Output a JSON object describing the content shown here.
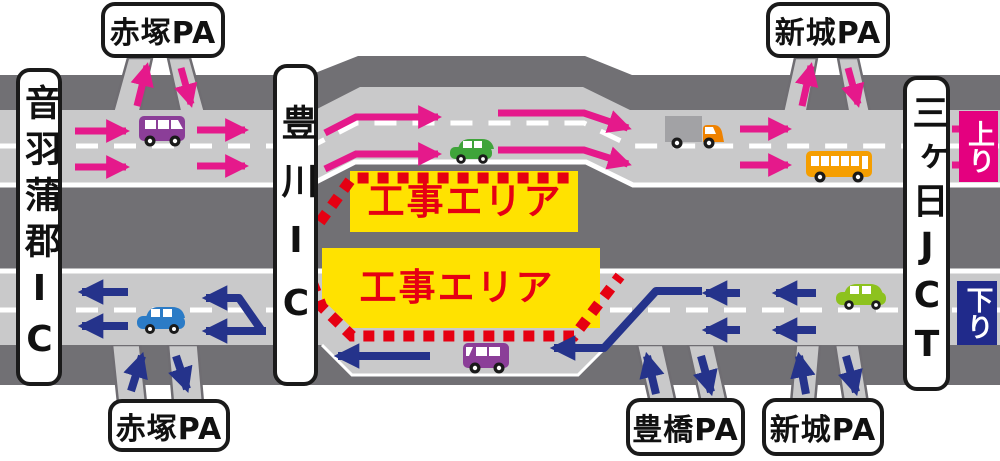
{
  "labels": {
    "pa_akatsuka": "赤塚PA",
    "pa_shinshiro": "新城PA",
    "pa_toyohashi": "豊橋PA",
    "ic_otowa_gamagori": "音羽蒲郡IC",
    "ic_toyokawa": "豊川IC",
    "jct_mikkabi": "三ヶ日JCT",
    "direction_up": "上り",
    "direction_down": "下り",
    "construction_area": "工事エリア"
  },
  "colors": {
    "up_accent": "#e4007f",
    "down_accent": "#202a8b",
    "construction_bg": "#ffe200",
    "construction_text": "#e60012",
    "dotted_line_red": "#e60012",
    "road_surface": "#c9c9ca",
    "road_base": "#717074",
    "lane_marking": "#ffffff"
  },
  "vehicles": [
    {
      "type": "van",
      "color": "#8b3e98",
      "road": "up"
    },
    {
      "type": "car",
      "color": "#3fa43a",
      "road": "up"
    },
    {
      "type": "truck",
      "color": "#ef8200",
      "road": "up"
    },
    {
      "type": "bus",
      "color": "#f59e00",
      "road": "up"
    },
    {
      "type": "car",
      "color": "#2b7bc6",
      "road": "down"
    },
    {
      "type": "van",
      "color": "#8b3e98",
      "road": "down"
    },
    {
      "type": "car",
      "color": "#8dc21e",
      "road": "down"
    }
  ]
}
